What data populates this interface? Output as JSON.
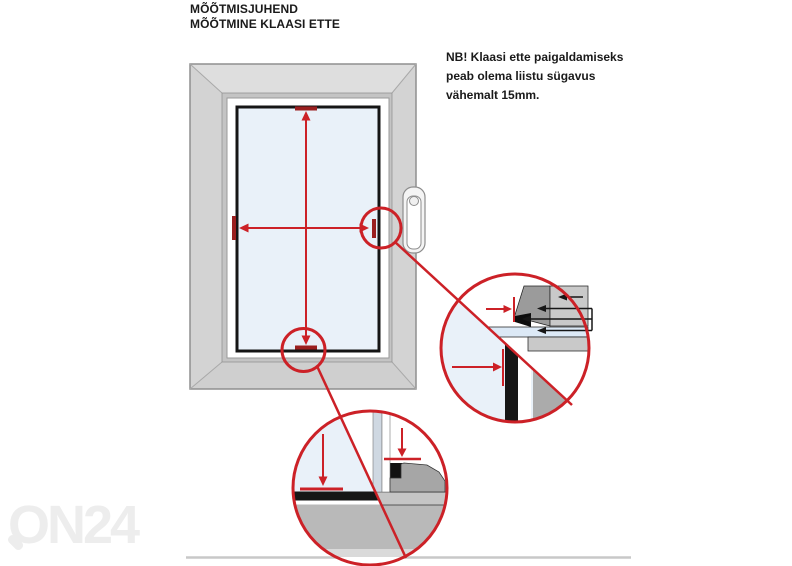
{
  "title": {
    "line1": "MÕÕTMISJUHEND",
    "line2": "MÕÕTMINE KLAASI ETTE"
  },
  "note": {
    "line1": "NB! Klaasi ette paigaldamiseks",
    "line2": "peab olema liistu sügavus",
    "line3": "vähemalt 15mm."
  },
  "watermark": {
    "text": "ON24"
  },
  "colors": {
    "accent_red": "#cc2127",
    "tick_dark_red": "#9a1f1f",
    "glass_blue": "#e9f1f9",
    "frame_gray": "#d8d8d8",
    "rebate_gray": "#c4c4c4",
    "detail_dark_gray": "#9b9b9b",
    "detail_mid_gray": "#c9c9c9",
    "sill_gray": "#b9b9b9",
    "ink_black": "#1a1a1a",
    "watermark_gray": "#ededed"
  }
}
